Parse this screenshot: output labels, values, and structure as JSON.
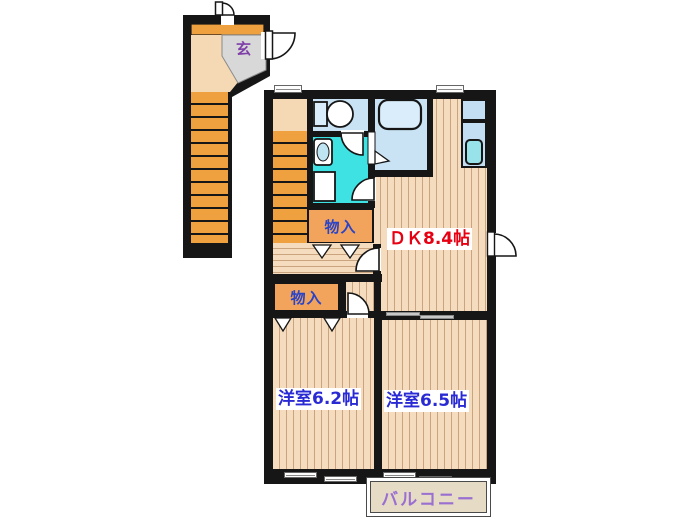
{
  "floorplan": {
    "type": "apartment-floor-plan-2DK",
    "entrance": {
      "label": "玄",
      "label_color": "#7e3fa8",
      "floor_color": "#d8d8d8"
    },
    "dk": {
      "label": "ＤＫ8.4帖",
      "size_jo": 8.4,
      "label_color": "#e60012"
    },
    "room_left": {
      "label": "洋室6.2帖",
      "size_jo": 6.2,
      "label_color": "#2a2ad4"
    },
    "room_right": {
      "label": "洋室6.5帖",
      "size_jo": 6.5,
      "label_color": "#2a2ad4"
    },
    "closet_upper": {
      "label": "物入",
      "label_color": "#2a44c8"
    },
    "closet_lower": {
      "label": "物入",
      "label_color": "#2a44c8"
    },
    "balcony": {
      "label": "バルコニー",
      "label_color": "#9a6fd0"
    },
    "colors": {
      "wall": "#161616",
      "wood_floor": "#f6dcbe",
      "wood_floor_line": "#c9a47e",
      "stairs": "#efa140",
      "landing": "#f5d8b4",
      "bathroom": "#c9e3f4",
      "washroom": "#3fe2e3",
      "closet": "#f2a45c",
      "balcony_floor": "#e6dcc6",
      "counter": "#c3def3",
      "counter_sink": "#98e3ea"
    }
  }
}
